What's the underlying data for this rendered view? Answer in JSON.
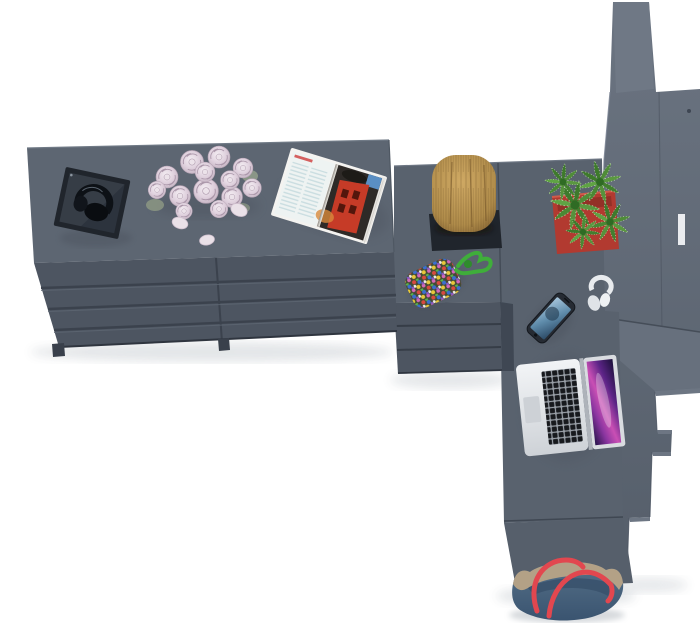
{
  "scene": {
    "description": "Top-down 3D render of a graphite-gray furniture set: a long dresser with drawers, a corner desk with an under-desk drawer unit and front panel, and a tall stepped shelving unit. Decor: open magazine, bouquet of pale roses with fallen petals, dark tray with headphones, wooden stump, cactus in a red pot, beaded pouch with green cord, smartphone, white earphones, open laptop and a denim tote bag on the floor.",
    "background": "#ffffff"
  },
  "colors": {
    "furniture_top": "#5d6672",
    "furniture_top_edge": "#707a86",
    "furniture_front": "#4d5561",
    "furniture_groove": "#3b424d",
    "furniture_side": "#3f4753",
    "desk_top": "#59626e",
    "panel_front": "#565f6b",
    "unit_top": "#6f7885",
    "unit_grad_top": "#6b7481",
    "unit_grad_bottom": "#555e6a",
    "step_top": "#67707d",
    "tray_dark": "#20252c",
    "wood_light": "#cfa964",
    "wood_dark": "#7e5e30",
    "pot_red": "#b23a30",
    "cactus_green": "#4f8c38",
    "cactus_green_dark": "#2f6b24",
    "magazine_red": "#c63b27",
    "magazine_page": "#eef3f2",
    "rose_pink": "#decfdc",
    "petal_pink": "#eae1e8",
    "cord_green": "#3fae3a",
    "phone_screen_blue": "#5f8cab",
    "laptop_silver": "#d9dce0",
    "laptop_key": "#17191d",
    "screen_magenta": "#c94fb4",
    "screen_violet": "#5c2487",
    "bag_denim": "#47617c",
    "bag_trim": "#b3a186",
    "strap_red": "#e2474f",
    "shadow": "#454c57"
  },
  "items": {
    "dresser": "Gray dresser with drawers",
    "desk": "Gray corner desk",
    "drawer_unit": "Under-desk drawer unit",
    "front_panel": "Desk front panel",
    "shelving": "Tall stepped shelving unit",
    "magazine": "Open magazine with red building photo",
    "bouquet": "Bouquet of pale roses",
    "petals": "Fallen rose petals",
    "tray": "Dark tray with headphones",
    "stump": "Decorative wooden stump on dark base",
    "cactus": "Cactus in red square pot",
    "beads": "Beaded pouch with green cord",
    "phone": "Smartphone with blue screen",
    "earphones": "White earphones",
    "laptop": "Open silver laptop with galaxy wallpaper",
    "bag": "Denim tote bag with red straps"
  }
}
